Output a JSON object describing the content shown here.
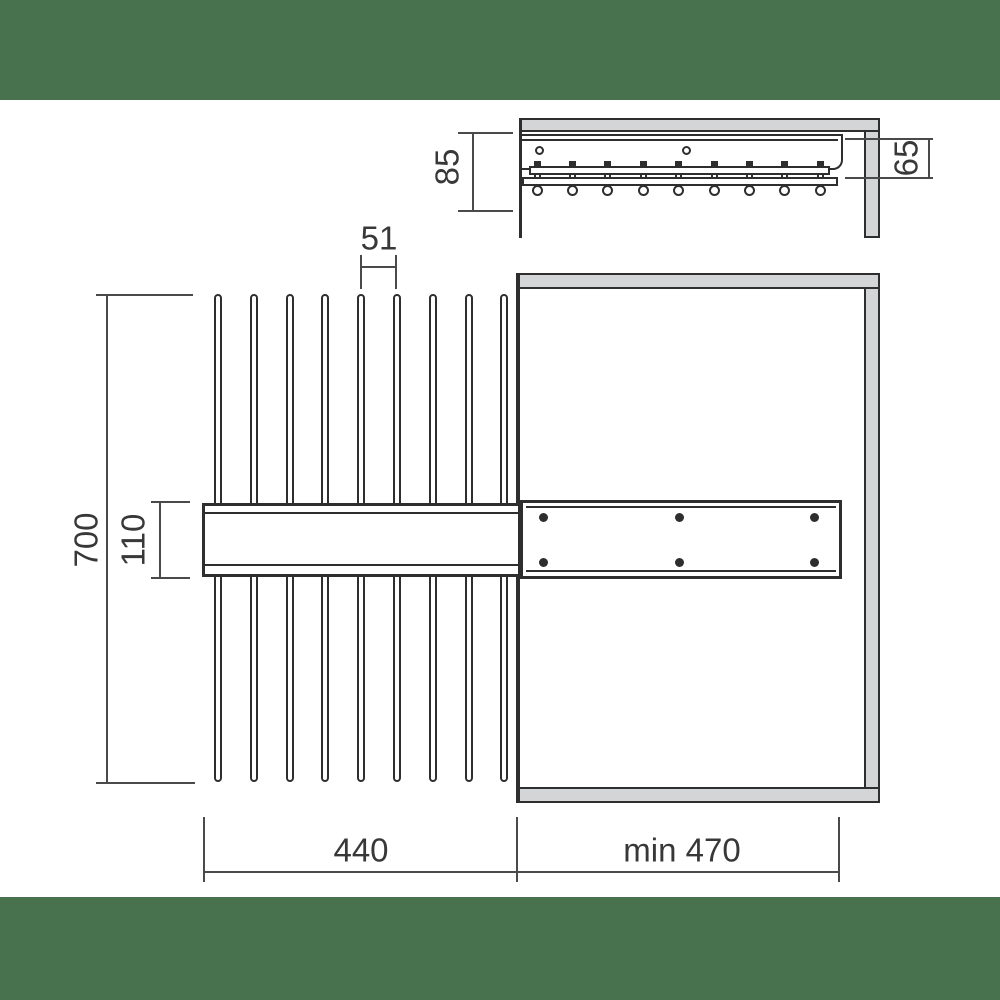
{
  "colors": {
    "band": "#48714D",
    "panel": "#D4D5D7",
    "line": "#2E2E2E",
    "dim": "#4A4A4A",
    "ink": "#383838"
  },
  "side_view": {
    "dimensions": {
      "mounting_height": "85",
      "drop_depth": "65"
    },
    "hook_count": 9,
    "screw_hole_count": 2
  },
  "plan_view": {
    "dimensions": {
      "total_height": "700",
      "rail_height": "110",
      "rod_spacing": "51",
      "pullout_length": "440",
      "cabinet_depth_min": "min 470"
    },
    "rod_count": 9,
    "plate_hole_cols": 3,
    "plate_hole_rows": 2
  }
}
